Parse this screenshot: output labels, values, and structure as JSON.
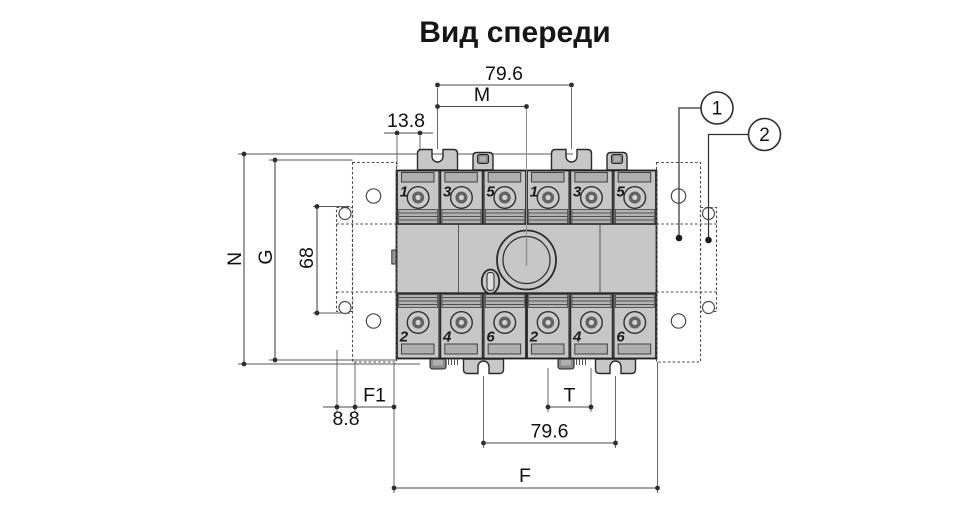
{
  "title": "Вид спереди",
  "dimensions": {
    "top_width": "79.6",
    "m": "M",
    "left_offset": "13.8",
    "n": "N",
    "g": "G",
    "hole_pitch": "68",
    "f1": "F1",
    "edge_offset": "8.8",
    "t": "T",
    "bottom_width": "79.6",
    "f": "F"
  },
  "callouts": [
    {
      "label": "1"
    },
    {
      "label": "2"
    }
  ],
  "terminals": {
    "top": [
      "1",
      "3",
      "5",
      "1",
      "3",
      "5"
    ],
    "bottom": [
      "2",
      "4",
      "6",
      "2",
      "4",
      "6"
    ]
  },
  "colors": {
    "background": "#ffffff",
    "body_fill": "#c7c7c7",
    "outline": "#2a2a2a",
    "dimension_line": "#4a4a4a",
    "text": "#111111"
  }
}
